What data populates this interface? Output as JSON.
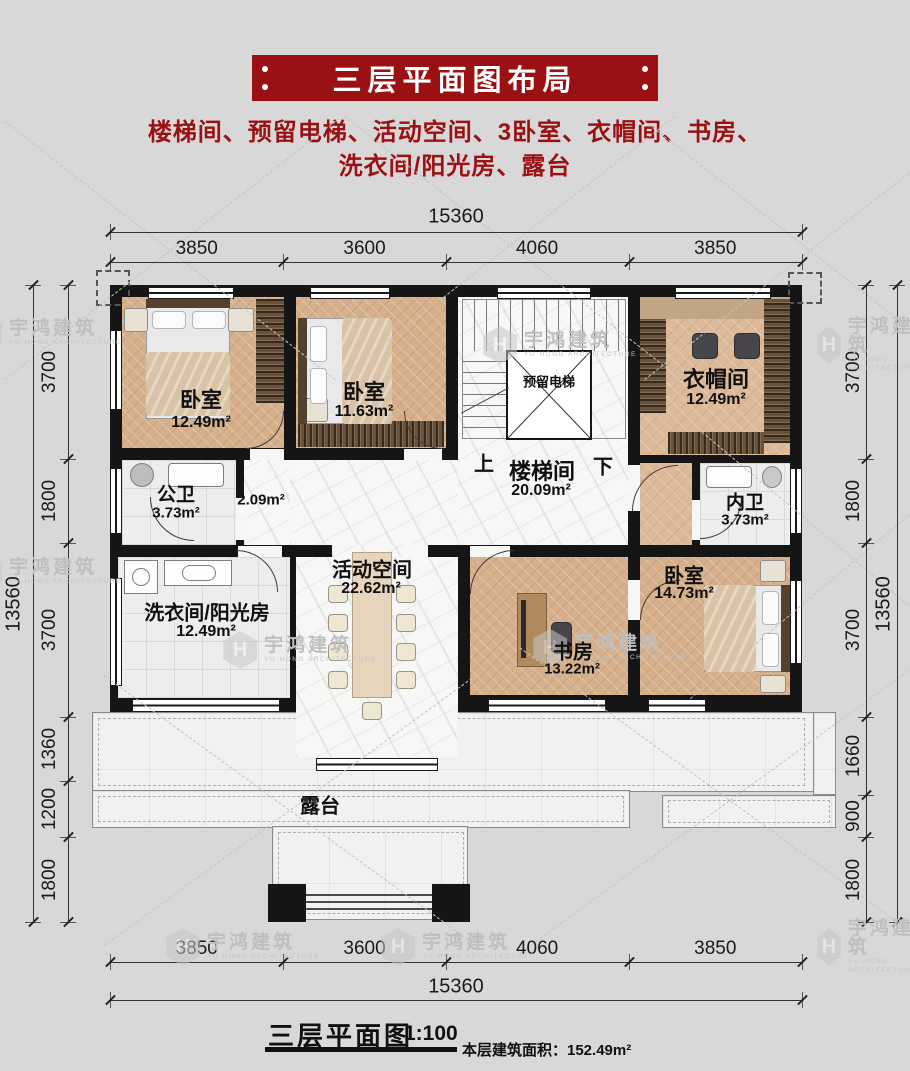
{
  "header": {
    "title": "三层平面图布局",
    "subtitle1": "楼梯间、预留电梯、活动空间、3卧室、衣帽间、书房、",
    "subtitle2": "洗衣间/阳光房、露台"
  },
  "rooms": {
    "bedroom1": {
      "name": "卧室",
      "area": "12.49m²"
    },
    "bedroom2": {
      "name": "卧室",
      "area": "11.63m²"
    },
    "elevator": {
      "name": "预留电梯"
    },
    "cloakroom": {
      "name": "衣帽间",
      "area": "12.49m²"
    },
    "stairwell": {
      "name": "楼梯间",
      "area": "20.09m²",
      "up": "上",
      "down": "下"
    },
    "public_bath": {
      "name": "公卫",
      "area": "3.73m²"
    },
    "hallway": {
      "area": "2.09m²"
    },
    "ensuite": {
      "name": "内卫",
      "area": "3.73m²"
    },
    "laundry": {
      "name": "洗衣间/阳光房",
      "area": "12.49m²"
    },
    "activity": {
      "name": "活动空间",
      "area": "22.62m²"
    },
    "study": {
      "name": "书房",
      "area": "13.22m²"
    },
    "bedroom3": {
      "name": "卧室",
      "area": "14.73m²"
    },
    "terrace": {
      "name": "露台"
    }
  },
  "dimensions": {
    "top": {
      "total": "15360",
      "segments": [
        "3850",
        "3600",
        "4060",
        "3850"
      ]
    },
    "bottom": {
      "total": "15360",
      "segments": [
        "3850",
        "3600",
        "4060",
        "3850"
      ]
    },
    "left": {
      "total": "13560",
      "segments": [
        "3700",
        "1800",
        "3700",
        "1360",
        "1200",
        "1800"
      ]
    },
    "right": {
      "total": "13560",
      "segments": [
        "3700",
        "1800",
        "3700",
        "1660",
        "900",
        "1800"
      ]
    }
  },
  "footer": {
    "title": "三层平面图",
    "scale": "1:100",
    "area_label": "本层建筑面积：152.49m²"
  },
  "watermark": {
    "text": "宇鸿建筑",
    "subtext": "YU HONG ARCHITECTURE"
  },
  "colors": {
    "banner_red": "#9a1013",
    "wall_black": "#151515",
    "wood_floor": "#d6af8b",
    "marble": "#f7f7f5"
  }
}
